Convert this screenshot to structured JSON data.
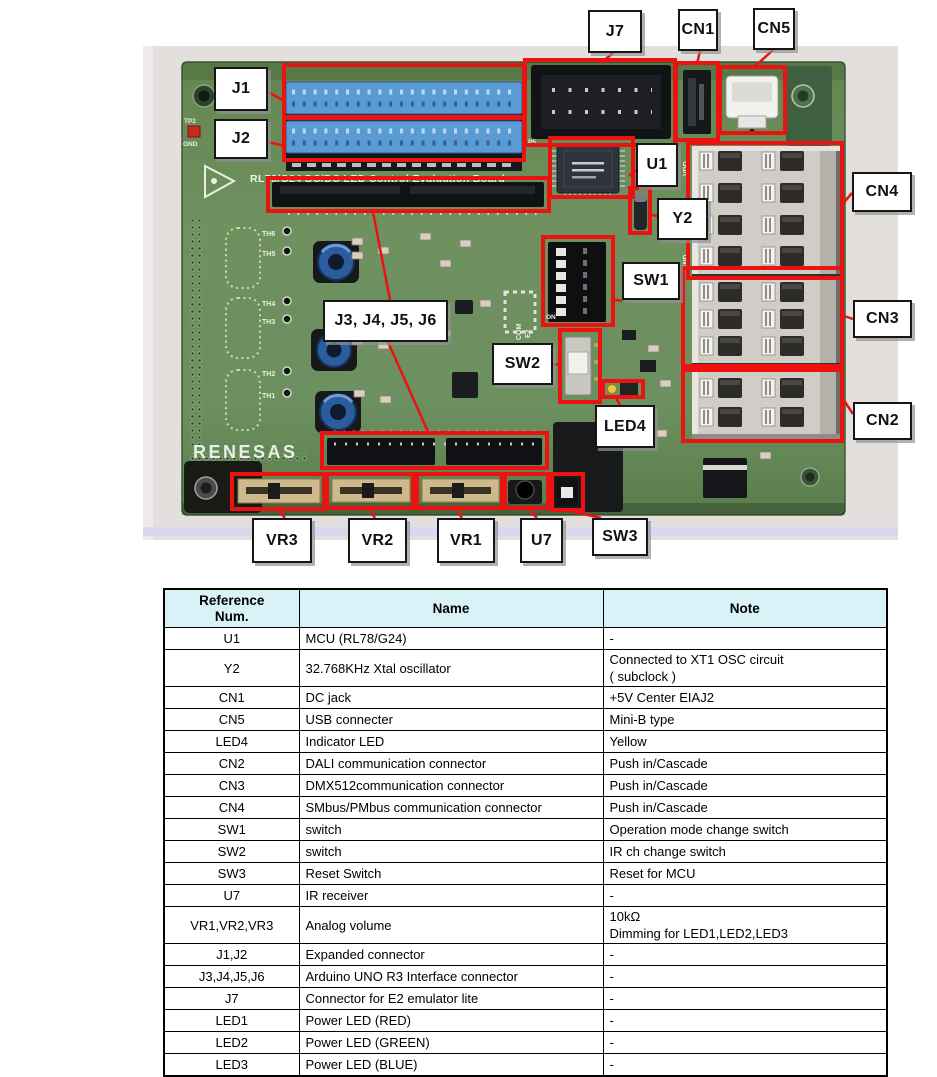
{
  "figure": {
    "annotation_color": "#ec1212",
    "photo_bg": "#e2dfdc",
    "board": {
      "logo_text": "RENESAS",
      "silkscreen_title": "RL78/G24 DC/DC LED Control Evaluation Board",
      "silk_texts": [
        {
          "t": "TP2",
          "x": 184,
          "y": 123,
          "s": 6.5
        },
        {
          "t": "GND",
          "x": 183,
          "y": 146,
          "s": 6.5
        },
        {
          "t": "TH6",
          "x": 262,
          "y": 236,
          "s": 7
        },
        {
          "t": "TH5",
          "x": 262,
          "y": 256,
          "s": 7
        },
        {
          "t": "TH4",
          "x": 262,
          "y": 306,
          "s": 7
        },
        {
          "t": "TH3",
          "x": 262,
          "y": 324,
          "s": 7
        },
        {
          "t": "TH2",
          "x": 262,
          "y": 376,
          "s": 7
        },
        {
          "t": "TH1",
          "x": 262,
          "y": 398,
          "s": 7
        },
        {
          "t": "ON",
          "x": 546,
          "y": 319,
          "s": 6.5
        },
        {
          "t": "COM",
          "x": 521,
          "y": 340,
          "s": 7,
          "rot": -90
        },
        {
          "t": "E2",
          "x": 530,
          "y": 338,
          "s": 7,
          "rot": -90
        },
        {
          "t": "VDD",
          "x": 688,
          "y": 176,
          "s": 7,
          "rot": -90
        },
        {
          "t": "GND",
          "x": 688,
          "y": 270,
          "s": 7,
          "rot": -90
        },
        {
          "t": "P5",
          "x": 528,
          "y": 144,
          "s": 6.5
        }
      ]
    },
    "callouts": [
      {
        "label": "J1",
        "labelBox": [
          214,
          67,
          54,
          44
        ],
        "targets": [
          [
            284,
            65,
            240,
            52
          ]
        ],
        "lines": [
          [
            [
              268,
              92
            ],
            [
              286,
              102
            ]
          ]
        ]
      },
      {
        "label": "J2",
        "labelBox": [
          214,
          119,
          54,
          40
        ],
        "targets": [
          [
            284,
            118,
            240,
            42
          ]
        ],
        "lines": [
          [
            [
              268,
              142
            ],
            [
              286,
              146
            ]
          ]
        ]
      },
      {
        "label": "J7",
        "labelBox": [
          588,
          10,
          54,
          43
        ],
        "targets": [
          [
            525,
            60,
            150,
            85
          ]
        ],
        "lines": [
          [
            [
              613,
              53
            ],
            [
              601,
              63
            ]
          ]
        ]
      },
      {
        "label": "CN1",
        "labelBox": [
          678,
          9,
          40,
          42
        ],
        "targets": [
          [
            676,
            63,
            42,
            77
          ]
        ],
        "lines": [
          [
            [
              700,
              51
            ],
            [
              697,
              64
            ]
          ]
        ]
      },
      {
        "label": "CN5",
        "labelBox": [
          753,
          8,
          42,
          42
        ],
        "targets": [
          [
            720,
            67,
            65,
            66
          ]
        ],
        "lines": [
          [
            [
              773,
              50
            ],
            [
              753,
              68
            ]
          ]
        ]
      },
      {
        "label": "U1",
        "labelBox": [
          636,
          143,
          42,
          44
        ],
        "targets": [
          [
            550,
            138,
            83,
            59
          ]
        ],
        "lines": [
          [
            [
              636,
              170
            ],
            [
              629,
              176
            ]
          ]
        ]
      },
      {
        "label": "Y2",
        "labelBox": [
          657,
          198,
          51,
          42
        ],
        "targets": [
          [
            630,
            188,
            20,
            45
          ]
        ],
        "lines": [
          [
            [
              657,
              216
            ],
            [
              649,
              214
            ]
          ]
        ]
      },
      {
        "label": "SW1",
        "labelBox": [
          622,
          262,
          58,
          38
        ],
        "targets": [
          [
            543,
            237,
            70,
            88
          ]
        ],
        "lines": [
          [
            [
              622,
              301
            ],
            [
              612,
              299
            ]
          ]
        ]
      },
      {
        "label": "CN4",
        "labelBox": [
          852,
          172,
          60,
          40
        ],
        "targets": [
          [
            688,
            143,
            154,
            135
          ]
        ],
        "lines": [
          [
            [
              852,
              193
            ],
            [
              840,
              207
            ]
          ]
        ]
      },
      {
        "label": "CN3",
        "labelBox": [
          853,
          300,
          59,
          38
        ],
        "targets": [
          [
            683,
            268,
            159,
            98
          ]
        ],
        "lines": [
          [
            [
              853,
              319
            ],
            [
              841,
              315
            ]
          ]
        ]
      },
      {
        "label": "CN2",
        "labelBox": [
          853,
          402,
          59,
          38
        ],
        "targets": [
          [
            683,
            370,
            159,
            71
          ]
        ],
        "lines": [
          [
            [
              853,
              414
            ],
            [
              841,
              396
            ]
          ]
        ]
      },
      {
        "label": "J3, J4, J5, J6",
        "labelBox": [
          323,
          300,
          125,
          42
        ],
        "targets": [
          [
            268,
            178,
            281,
            33
          ],
          [
            322,
            433,
            225,
            35
          ]
        ],
        "lines": [
          [
            [
              390,
              300
            ],
            [
              373,
              212
            ]
          ],
          [
            [
              388,
              342
            ],
            [
              429,
              434
            ]
          ]
        ]
      },
      {
        "label": "SW2",
        "labelBox": [
          492,
          343,
          61,
          42
        ],
        "targets": [
          [
            560,
            330,
            40,
            72
          ]
        ],
        "lines": [
          [
            [
              553,
              364
            ],
            [
              561,
              365
            ]
          ]
        ]
      },
      {
        "label": "LED4",
        "labelBox": [
          595,
          405,
          60,
          43
        ],
        "targets": [
          [
            603,
            381,
            40,
            16
          ]
        ],
        "lines": [
          [
            [
              620,
              405
            ],
            [
              616,
              398
            ]
          ]
        ]
      },
      {
        "label": "VR3",
        "labelBox": [
          252,
          518,
          60,
          45
        ],
        "targets": [
          [
            232,
            474,
            92,
            35
          ]
        ],
        "lines": [
          [
            [
              285,
              518
            ],
            [
              278,
              510
            ]
          ]
        ]
      },
      {
        "label": "VR2",
        "labelBox": [
          348,
          518,
          59,
          45
        ],
        "targets": [
          [
            327,
            474,
            86,
            34
          ]
        ],
        "lines": [
          [
            [
              375,
              518
            ],
            [
              369,
              509
            ]
          ]
        ]
      },
      {
        "label": "VR1",
        "labelBox": [
          437,
          518,
          58,
          45
        ],
        "targets": [
          [
            417,
            474,
            85,
            34
          ]
        ],
        "lines": [
          [
            [
              462,
              518
            ],
            [
              456,
              509
            ]
          ]
        ]
      },
      {
        "label": "U7",
        "labelBox": [
          520,
          518,
          43,
          45
        ],
        "targets": [
          [
            505,
            474,
            43,
            34
          ]
        ],
        "lines": [
          [
            [
              537,
              518
            ],
            [
              528,
              509
            ]
          ]
        ]
      },
      {
        "label": "SW3",
        "labelBox": [
          592,
          518,
          56,
          38
        ],
        "targets": [
          [
            552,
            474,
            31,
            36
          ]
        ],
        "lines": [
          [
            [
              601,
              518
            ],
            [
              571,
              511
            ]
          ]
        ]
      }
    ]
  },
  "table": {
    "headers": {
      "ref": "Reference\nNum.",
      "name": "Name",
      "note": "Note"
    },
    "rows": [
      {
        "ref": "U1",
        "name": "MCU (RL78/G24)",
        "note": "-"
      },
      {
        "ref": "Y2",
        "name": "32.768KHz Xtal oscillator",
        "note": "Connected to XT1 OSC circuit\n ( subclock )"
      },
      {
        "ref": "CN1",
        "name": "DC jack",
        "note": "+5V Center EIAJ2"
      },
      {
        "ref": "CN5",
        "name": "USB connecter",
        "note": "Mini-B type"
      },
      {
        "ref": "LED4",
        "name": "Indicator LED",
        "note": "Yellow"
      },
      {
        "ref": "CN2",
        "name": "DALI communication connector",
        "note": "Push in/Cascade"
      },
      {
        "ref": "CN3",
        "name": "DMX512communication connector",
        "note": "Push in/Cascade"
      },
      {
        "ref": "CN4",
        "name": "SMbus/PMbus communication connector",
        "note": "Push in/Cascade"
      },
      {
        "ref": "SW1",
        "name": "switch",
        "note": "Operation mode change switch"
      },
      {
        "ref": "SW2",
        "name": "switch",
        "note": "IR ch change switch"
      },
      {
        "ref": "SW3",
        "name": "Reset Switch",
        "note": "Reset for MCU"
      },
      {
        "ref": "U7",
        "name": "IR receiver",
        "note": "-"
      },
      {
        "ref": "VR1,VR2,VR3",
        "name": "Analog volume",
        "note": "10kΩ\nDimming for LED1,LED2,LED3"
      },
      {
        "ref": "J1,J2",
        "name": "Expanded connector",
        "note": "-"
      },
      {
        "ref": "J3,J4,J5,J6",
        "name": "Arduino UNO R3 Interface connector",
        "note": "-"
      },
      {
        "ref": "J7",
        "name": "Connector for E2 emulator lite",
        "note": "-"
      },
      {
        "ref": "LED1",
        "name": "Power LED (RED)",
        "note": "-"
      },
      {
        "ref": "LED2",
        "name": "Power LED (GREEN)",
        "note": "-"
      },
      {
        "ref": "LED3",
        "name": "Power LED (BLUE)",
        "note": "-"
      }
    ]
  }
}
